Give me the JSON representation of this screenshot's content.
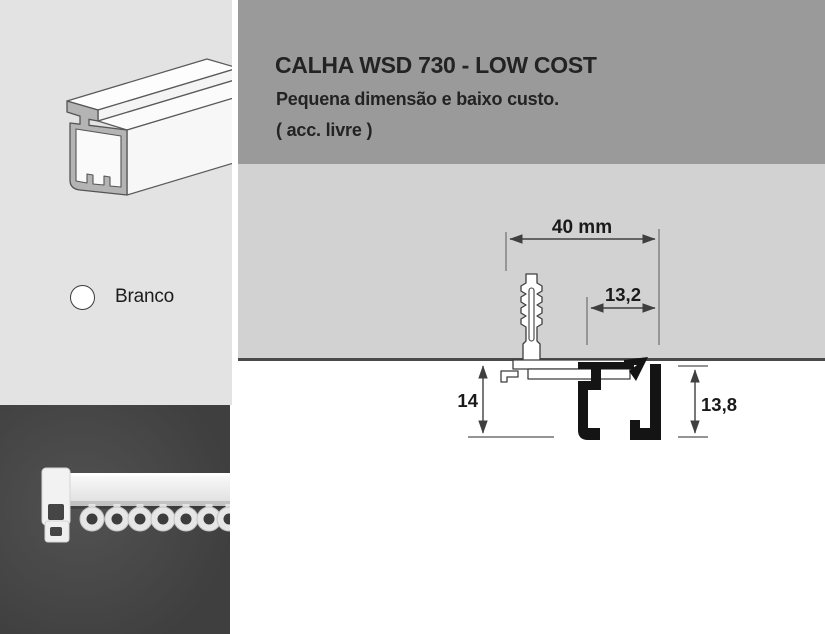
{
  "product": {
    "title": "CALHA WSD 730 - LOW COST",
    "subtitle": "Pequena dimensão e baixo custo.",
    "note": "( acc. livre )"
  },
  "finish": {
    "label": "Branco",
    "swatch_color": "#ffffff"
  },
  "diagram": {
    "width_label": "40 mm",
    "offset_label": "13,2",
    "drop_label": "14",
    "rail_height_label": "13,8"
  },
  "theme": {
    "header_band": "#9a9a9a",
    "ceiling_gray": "#d2d2d2",
    "left_panel_gray": "#e3e3e3",
    "photo_background": "#474747",
    "line_color": "#4a4a4a",
    "text_color": "#232323"
  }
}
